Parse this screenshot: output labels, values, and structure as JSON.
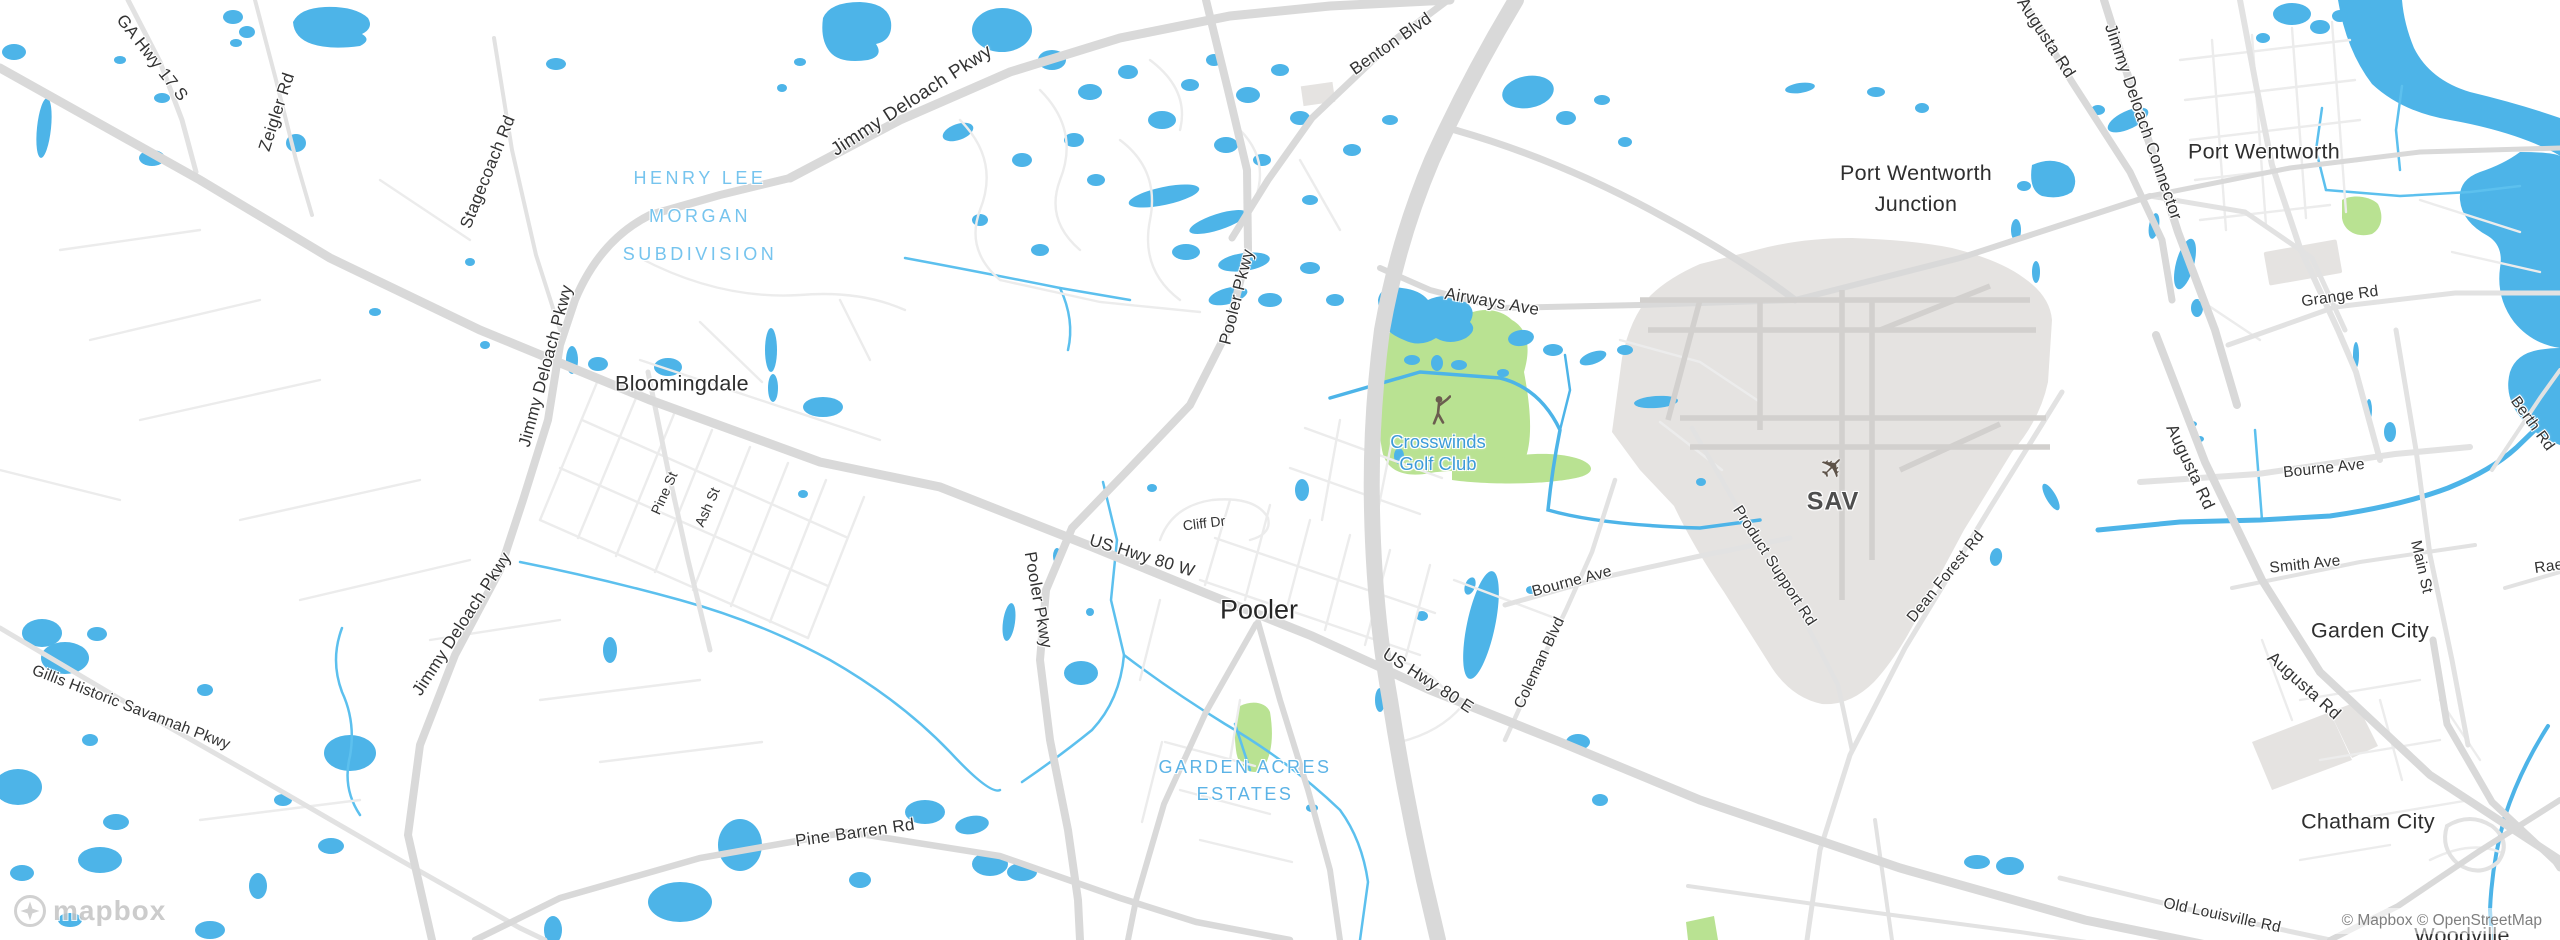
{
  "labels": {
    "cities": {
      "bloomingdale": "Bloomingdale",
      "pooler": "Pooler",
      "port_wentworth_junction": {
        "line1": "Port Wentworth",
        "line2": "Junction"
      },
      "port_wentworth": "Port Wentworth",
      "garden_city": "Garden City",
      "chatham_city": "Chatham City",
      "woodville": "Woodville"
    },
    "roads": {
      "ga_hwy_17_s": "GA Hwy 17 S",
      "zeigler_rd": "Zeigler Rd",
      "stagecoach_rd": "Stagecoach Rd",
      "jimmy_deloach_pkwy_top": "Jimmy Deloach Pkwy",
      "jimmy_deloach_pkwy_west": "Jimmy Deloach Pkwy",
      "jimmy_deloach_pkwy_sw": "Jimmy Deloach Pkwy",
      "benton_blvd": "Benton Blvd",
      "pooler_pkwy_n": "Pooler Pkwy",
      "pooler_pkwy_s": "Pooler Pkwy",
      "airways_ave": "Airways Ave",
      "jimmy_deloach_connector": "Jimmy Deloach Connector",
      "augusta_rd_n": "Augusta Rd",
      "augusta_rd_mid": "Augusta Rd",
      "augusta_rd_s": "Augusta Rd",
      "grange_rd": "Grange Rd",
      "pine_st": "Pine St",
      "ash_st": "Ash St",
      "cliff_dr": "Cliff Dr",
      "us_hwy_80_w": "US Hwy 80 W",
      "us_hwy_80_e": "US Hwy 80 E",
      "coleman_blvd": "Coleman Blvd",
      "bourne_ave_mid": "Bourne Ave",
      "bourne_ave_e": "Bourne Ave",
      "product_support_rd": "Product Support Rd",
      "dean_forest_rd": "Dean Forest Rd",
      "berth_rd": "Berth Rd",
      "main_st": "Main St",
      "smith_ave": "Smith Ave",
      "rae_partial": "Rae",
      "old_louisville_rd": "Old Louisville Rd",
      "pine_barren_rd": "Pine Barren Rd",
      "gillis_historic_savannah_pkwy": "Gillis Historic Savannah Pkwy"
    },
    "areas": {
      "henry_lee_morgan": {
        "line1": "HENRY LEE",
        "line2": "MORGAN",
        "line3": "SUBDIVISION"
      },
      "garden_acres": {
        "line1": "GARDEN ACRES",
        "line2": "ESTATES"
      }
    },
    "pois": {
      "crosswinds_golf_club": {
        "line1": "Crosswinds",
        "line2": "Golf Club"
      },
      "sav_airport": "SAV"
    }
  },
  "icons": {
    "airplane": "✈",
    "golfer": "golfer-silhouette",
    "mapbox_star": "four-point-star"
  },
  "branding": {
    "logo_text": "mapbox",
    "attribution": "© Mapbox © OpenStreetMap"
  },
  "colors": {
    "water": "#4db4e8",
    "stream": "#5cc0ee",
    "golf_green": "#b9e292",
    "airport_gray": "#e5e3e1",
    "runway_gray": "#d2d0ce",
    "road_major": "#d9d9d9",
    "road_medium": "#e2e2e2",
    "road_minor": "#ececec",
    "area_label_blue": "#76c4ee",
    "poi_label_blue": "#3d9bd8",
    "label_dark": "#333333"
  }
}
